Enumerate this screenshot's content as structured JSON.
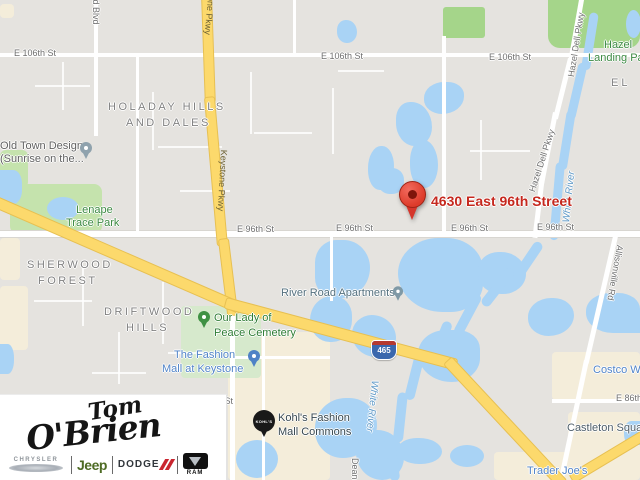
{
  "marker": {
    "address": "4630 East 96th Street"
  },
  "streets": {
    "e106": "E 106th St",
    "e96": "E 96th St",
    "e86": "E 86th St",
    "e86_right": "E 86th",
    "field_blvd": "field Blvd",
    "keystone": "Keystone Pkwy",
    "hazel_dell": "Hazel Dell Pkwy",
    "allisonville": "Allisonville Rd",
    "dean": "Dean"
  },
  "water": {
    "white_river": "White River"
  },
  "neighborhoods": {
    "holaday_line1": "HOLADAY HILLS",
    "holaday_line2": "AND DALES",
    "sherwood_line1": "SHERWOOD",
    "sherwood_line2": "FOREST",
    "driftwood_line1": "DRIFTWOOD",
    "driftwood_line2": "HILLS",
    "partial_east": "EL"
  },
  "parks": {
    "lenape_line1": "Lenape",
    "lenape_line2": "Trace Park",
    "hazel_landing_line1": "Hazel",
    "hazel_landing_line2": "Landing Park",
    "cemetery_line1": "Our Lady of",
    "cemetery_line2": "Peace Cemetery"
  },
  "pois": {
    "old_town_line1": "Old Town Design",
    "old_town_line2": "(Sunrise on the...",
    "river_road_apartments": "River Road Apartments",
    "fashion_mall_line1": "The Fashion",
    "fashion_mall_line2": "Mall at Keystone",
    "kohls_line1": "Kohl's Fashion",
    "kohls_line2": "Mall Commons",
    "kohls_badge": "KOHL'S",
    "costco": "Costco Wholesale",
    "castleton": "Castleton Square",
    "trader_joes": "Trader Joe's"
  },
  "highway": {
    "interstate_shield": "465"
  },
  "logo": {
    "name_top": "Tom",
    "name_bottom": "O'Brien",
    "brand_chrysler": "CHRYSLER",
    "brand_jeep": "Jeep",
    "brand_dodge": "DODGE",
    "brand_ram": "RAM"
  },
  "colors": {
    "map_base": "#e5e3df",
    "water": "#a9d3f5",
    "park_green": "#c5e3ad",
    "commercial_beige": "#f4edda",
    "highway_yellow": "#fcd96c",
    "marker_red": "#dd3b2a",
    "marker_label_red": "#c5281e",
    "poi_blue_text": "#5184c8",
    "park_green_text": "#3d8a43",
    "jeep_green": "#4e6b24",
    "dodge_red": "#c9252f"
  }
}
